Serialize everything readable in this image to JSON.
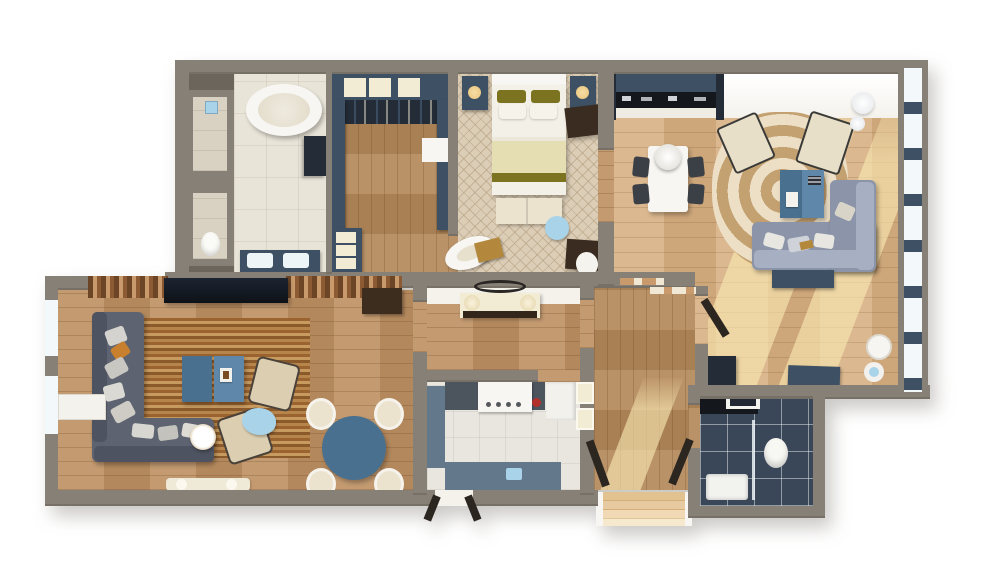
{
  "title": "3d-apartment-floor-plan-rendering",
  "palette": {
    "bg": "#ffffff",
    "wall": "#878076",
    "wall-dark": "#6b655c",
    "wall-face": "#f5f2ec",
    "wood": "#bf9366",
    "wood-light": "#d7b083",
    "wood-corridor": "#b48a5c",
    "navy": "#3d5064",
    "navy-dark": "#232c37",
    "black-counter": "#14171c",
    "cream": "#ece3cf",
    "cream-box": "#f3ecd5",
    "tile-bath": "#e9e4d8",
    "tile-stall": "#d9d2c3",
    "tile-kitchen": "#e9e6df",
    "bath2-floor": "#394759",
    "carpet": "#dbcdb6",
    "rug-cream": "#ecdfc6",
    "rug-tan": "#c4a171",
    "rug-brown": "#9a632f",
    "rug-stripe-light": "#c79b60",
    "slat-light": "#c89a6c",
    "slat-dark": "#6b4526",
    "olive": "#7b731f",
    "blanket": "#e5deb2",
    "duvet": "#f3f0e7",
    "lightblue": "#a8d3e9",
    "steel-blue": "#49708f",
    "steel-blue-light": "#5e87a9",
    "sofa-blue": "#8b94a9",
    "sofa-blue-light": "#a7b0c2",
    "sofa-slate": "#5d6370",
    "sofa-slate-dark": "#4d5360",
    "beige-chair": "#dbceb1",
    "gold": "#b3873c",
    "orange": "#c8802f",
    "kitchen2-cab": "#64788c",
    "counter-dark": "#4c545e",
    "glass": "#f3f8fa",
    "white": "#f7f6f2",
    "brown-cab": "#3c2d1f",
    "dark-brown": "#3a2c20",
    "door-panel": "#2c2620",
    "red": "#b3302a",
    "lamp-glow": "#e8c27a"
  },
  "scene": {
    "type": "3d-floor-plan-top-view",
    "rooms": [
      {
        "id": "master-bathroom",
        "floor": "cream-tile",
        "items": [
          "oval-freestanding-bathtub",
          "double-vanity",
          "vanity-sink-left",
          "vanity-sink-right",
          "wall-cabinet",
          "shower-stall",
          "rain-showerhead",
          "wc-stall",
          "toilet"
        ]
      },
      {
        "id": "walk-in-closet",
        "floor": "wood",
        "items": [
          "wardrobe-run",
          "storage-boxes",
          "hanging-rail",
          "left-cabinet-run",
          "right-cabinet-run",
          "linen-nook",
          "island-dresser",
          "island-drawers"
        ]
      },
      {
        "id": "bedroom",
        "floor": "patterned-carpet",
        "items": [
          "headboard",
          "double-bed",
          "olive-pillows",
          "white-pillows",
          "blanket-runner",
          "nightstand-left",
          "nightstand-right",
          "table-lamp-left",
          "table-lamp-right",
          "dresser",
          "foot-bench",
          "round-side-table",
          "chaise-lounge",
          "gold-ottoman",
          "corner-desk",
          "desk-chair"
        ]
      },
      {
        "id": "living-dining-kitchen",
        "floor": "light-wood",
        "items": [
          "kitchen-galley-cabinets",
          "black-countertop",
          "counter-appliances",
          "dining-table",
          "pedestal-vase",
          "dining-chairs",
          "ring-pattern-rug",
          "accent-armchair-left",
          "accent-armchair-right",
          "sphere-floor-lamp",
          "nesting-coffee-tables",
          "coffee-table-books",
          "corner-sectional-sofa",
          "sofa-pillows",
          "console-behind-sofa",
          "media-bench",
          "corner-storage-cabinet",
          "open-door-panel",
          "pouf-white",
          "pouf-blue-top",
          "window-wall-glazing",
          "sunlight-patches"
        ]
      },
      {
        "id": "family-room",
        "floor": "wood",
        "items": [
          "slat-tv-wall-left",
          "slat-tv-wall-right",
          "tv-console",
          "side-cabinet-brown",
          "striped-area-rug",
          "corner-sectional-slate",
          "sofa-pillows",
          "orange-accent-pillow",
          "twin-coffee-tables",
          "barrel-armchair-upper",
          "barrel-armchair-lower",
          "drum-side-table",
          "cloud-side-table",
          "round-dining-table",
          "tub-chair-1",
          "tub-chair-2",
          "tub-chair-3",
          "tub-chair-4",
          "window-bay-sill",
          "left-wall-glazing",
          "wall-bench"
        ]
      },
      {
        "id": "entry-hall",
        "floor": "wood",
        "items": [
          "console-table",
          "console-lamp-left",
          "console-lamp-right",
          "oval-wall-mirror",
          "display-trays"
        ]
      },
      {
        "id": "kitchen",
        "floor": "white-tile",
        "items": [
          "dark-counter-run",
          "range-with-hood",
          "red-kettle",
          "tall-white-cabinet",
          "left-base-cabinets",
          "bottom-base-cabinets",
          "blue-counter-item",
          "wall-niche-shelves",
          "exterior-door-panels"
        ]
      },
      {
        "id": "hallway",
        "floor": "wood",
        "items": [
          "open-door-panel-left",
          "open-door-panel-right",
          "entry-steps"
        ]
      },
      {
        "id": "second-bathroom",
        "floor": "dark-slate-tile",
        "items": [
          "dark-vanity",
          "ceiling-vent",
          "glass-shower-screen",
          "shower-tray",
          "toilet"
        ]
      }
    ]
  }
}
